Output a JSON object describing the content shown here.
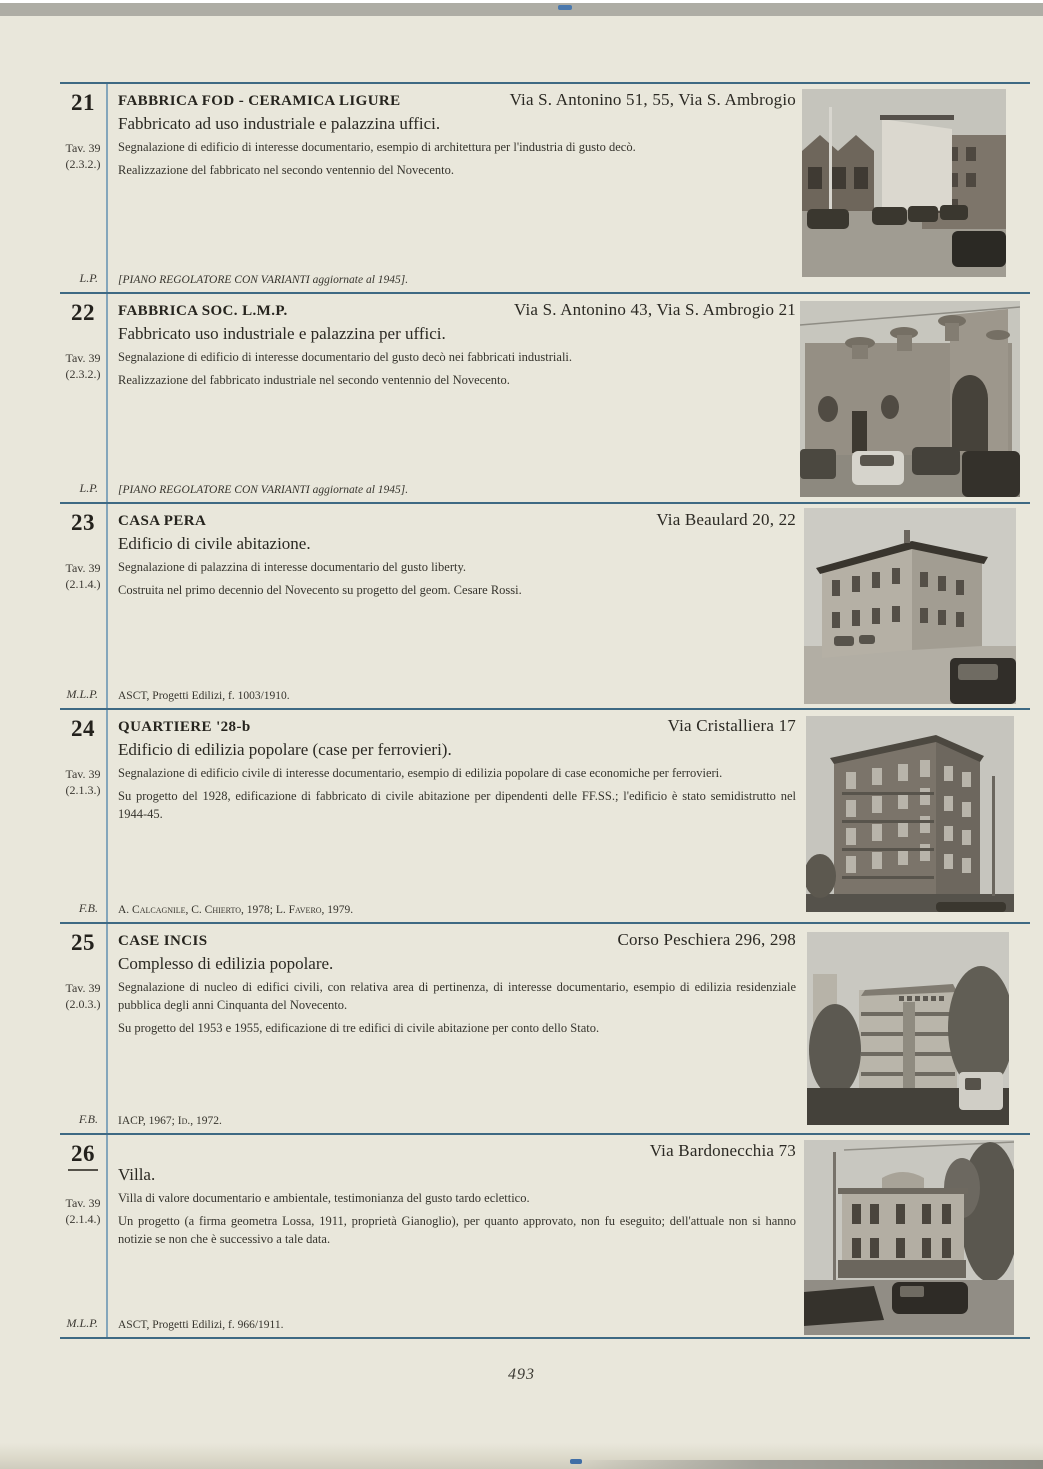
{
  "page": {
    "number": "493"
  },
  "colors": {
    "paper": "#e9e7db",
    "rule_horizontal": "#3e6983",
    "rule_vertical": "#84a6bb",
    "top_edge_band": "#aeada5",
    "registration_mark": "#4a78ad"
  },
  "entries": [
    {
      "number": "21",
      "tav": "Tav. 39",
      "code": "(2.3.2.)",
      "sig": "L.P.",
      "title": "FABBRICA FOD - CERAMICA LIGURE",
      "address": "Via S. Antonino 51, 55, Via S. Ambrogio",
      "subtitle": "Fabbricato ad uso industriale e palazzina uffici.",
      "para1": "Segnalazione di edificio di interesse documentario, esempio di architettura per l'industria di gusto decò.",
      "para2": "Realizzazione del fabbricato nel secondo ventennio del Novecento.",
      "ref": "[PIANO REGOLATORE CON VARIANTI aggiornate al 1945].",
      "ref_style": "italic",
      "photo_alt": "B/W photo: gabled industrial building and offices, cars parked along the street"
    },
    {
      "number": "22",
      "tav": "Tav. 39",
      "code": "(2.3.2.)",
      "sig": "L.P.",
      "title": "FABBRICA SOC. L.M.P.",
      "address": "Via S. Antonino 43, Via S. Ambrogio 21",
      "subtitle": "Fabbricato uso industriale e palazzina per uffici.",
      "para1": "Segnalazione di edificio di interesse documentario del gusto decò nei fabbricati industriali.",
      "para2": "Realizzazione del fabbricato industriale nel secondo ventennio del Novecento.",
      "ref": "[PIANO REGOLATORE CON VARIANTI aggiornate al 1945].",
      "ref_style": "italic",
      "photo_alt": "B/W photo: decò factory facade with turret pinnacles, cars parked in front"
    },
    {
      "number": "23",
      "tav": "Tav. 39",
      "code": "(2.1.4.)",
      "sig": "M.L.P.",
      "title": "CASA PERA",
      "address": "Via Beaulard 20, 22",
      "subtitle": "Edificio di civile abitazione.",
      "para1": "Segnalazione di palazzina di interesse documentario del gusto liberty.",
      "para2": "Costruita nel primo decennio del Novecento su progetto del geom. Cesare Rossi.",
      "ref": "ASCT, Progetti Edilizi, f. 1003/1910.",
      "ref_style": "plain",
      "photo_alt": "B/W photo: two-storey liberty corner house with balconies, dark car in foreground"
    },
    {
      "number": "24",
      "tav": "Tav. 39",
      "code": "(2.1.3.)",
      "sig": "F.B.",
      "title": "QUARTIERE '28-b",
      "address": "Via Cristalliera 17",
      "subtitle": "Edificio di edilizia popolare (case per ferrovieri).",
      "para1": "Segnalazione di edificio civile di interesse documentario, esempio di edilizia popolare di case economiche per ferrovieri.",
      "para2": "Su progetto del 1928, edificazione di fabbricato di civile abitazione per dipendenti delle FF.SS.; l'edificio è stato semidistrutto nel 1944-45.",
      "ref": "A. Calcagnile, C. Chierto, 1978; L. Favero, 1979.",
      "ref_style": "caps",
      "photo_alt": "B/W photo: tall corner apartment block with balconies on every floor"
    },
    {
      "number": "25",
      "tav": "Tav. 39",
      "code": "(2.0.3.)",
      "sig": "F.B.",
      "title": "CASE INCIS",
      "address": "Corso Peschiera 296, 298",
      "subtitle": "Complesso di edilizia popolare.",
      "para1": "Segnalazione di nucleo di edifici civili, con relativa area di pertinenza, di interesse documentario, esempio di edilizia residenziale pubblica degli anni Cinquanta del Novecento.",
      "para2": "Su progetto del 1953 e 1955, edificazione di tre edifici di civile abitazione per conto dello Stato.",
      "ref": "IACP, 1967; Id., 1972.",
      "ref_style": "caps",
      "photo_alt": "B/W photo: 1950s apartment block with balcony bands among trees, van at right"
    },
    {
      "number": "26",
      "number_underlined": "true",
      "tav": "Tav. 39",
      "code": "(2.1.4.)",
      "sig": "M.L.P.",
      "title": "",
      "address": "Via Bardonecchia 73",
      "subtitle": "Villa.",
      "para1": "Villa di valore documentario e ambientale, testimonianza del gusto tardo eclettico.",
      "para2": "Un progetto (a firma geometra Lossa, 1911, proprietà Gianoglio), per quanto approvato, non fu eseguito; dell'attuale non si hanno notizie se non che è successivo a tale data.",
      "ref": "ASCT, Progetti Edilizi, f. 966/1911.",
      "ref_style": "plain",
      "photo_alt": "B/W photo: two-storey eclectic villa with pediment, cars passing on the street"
    }
  ]
}
